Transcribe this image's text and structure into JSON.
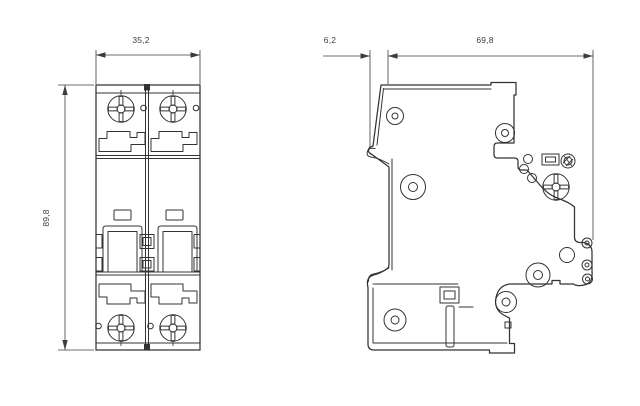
{
  "drawing": {
    "type": "technical-dimension-drawing",
    "subject": "2-pole miniature circuit breaker",
    "front_view": {
      "width_label": "35,2",
      "height_label": "89,8"
    },
    "side_view": {
      "clip_offset_label": "6,2",
      "depth_label": "69,8"
    },
    "colors": {
      "line": "#333333",
      "dimension": "#3d3d3d",
      "background": "#ffffff"
    }
  }
}
